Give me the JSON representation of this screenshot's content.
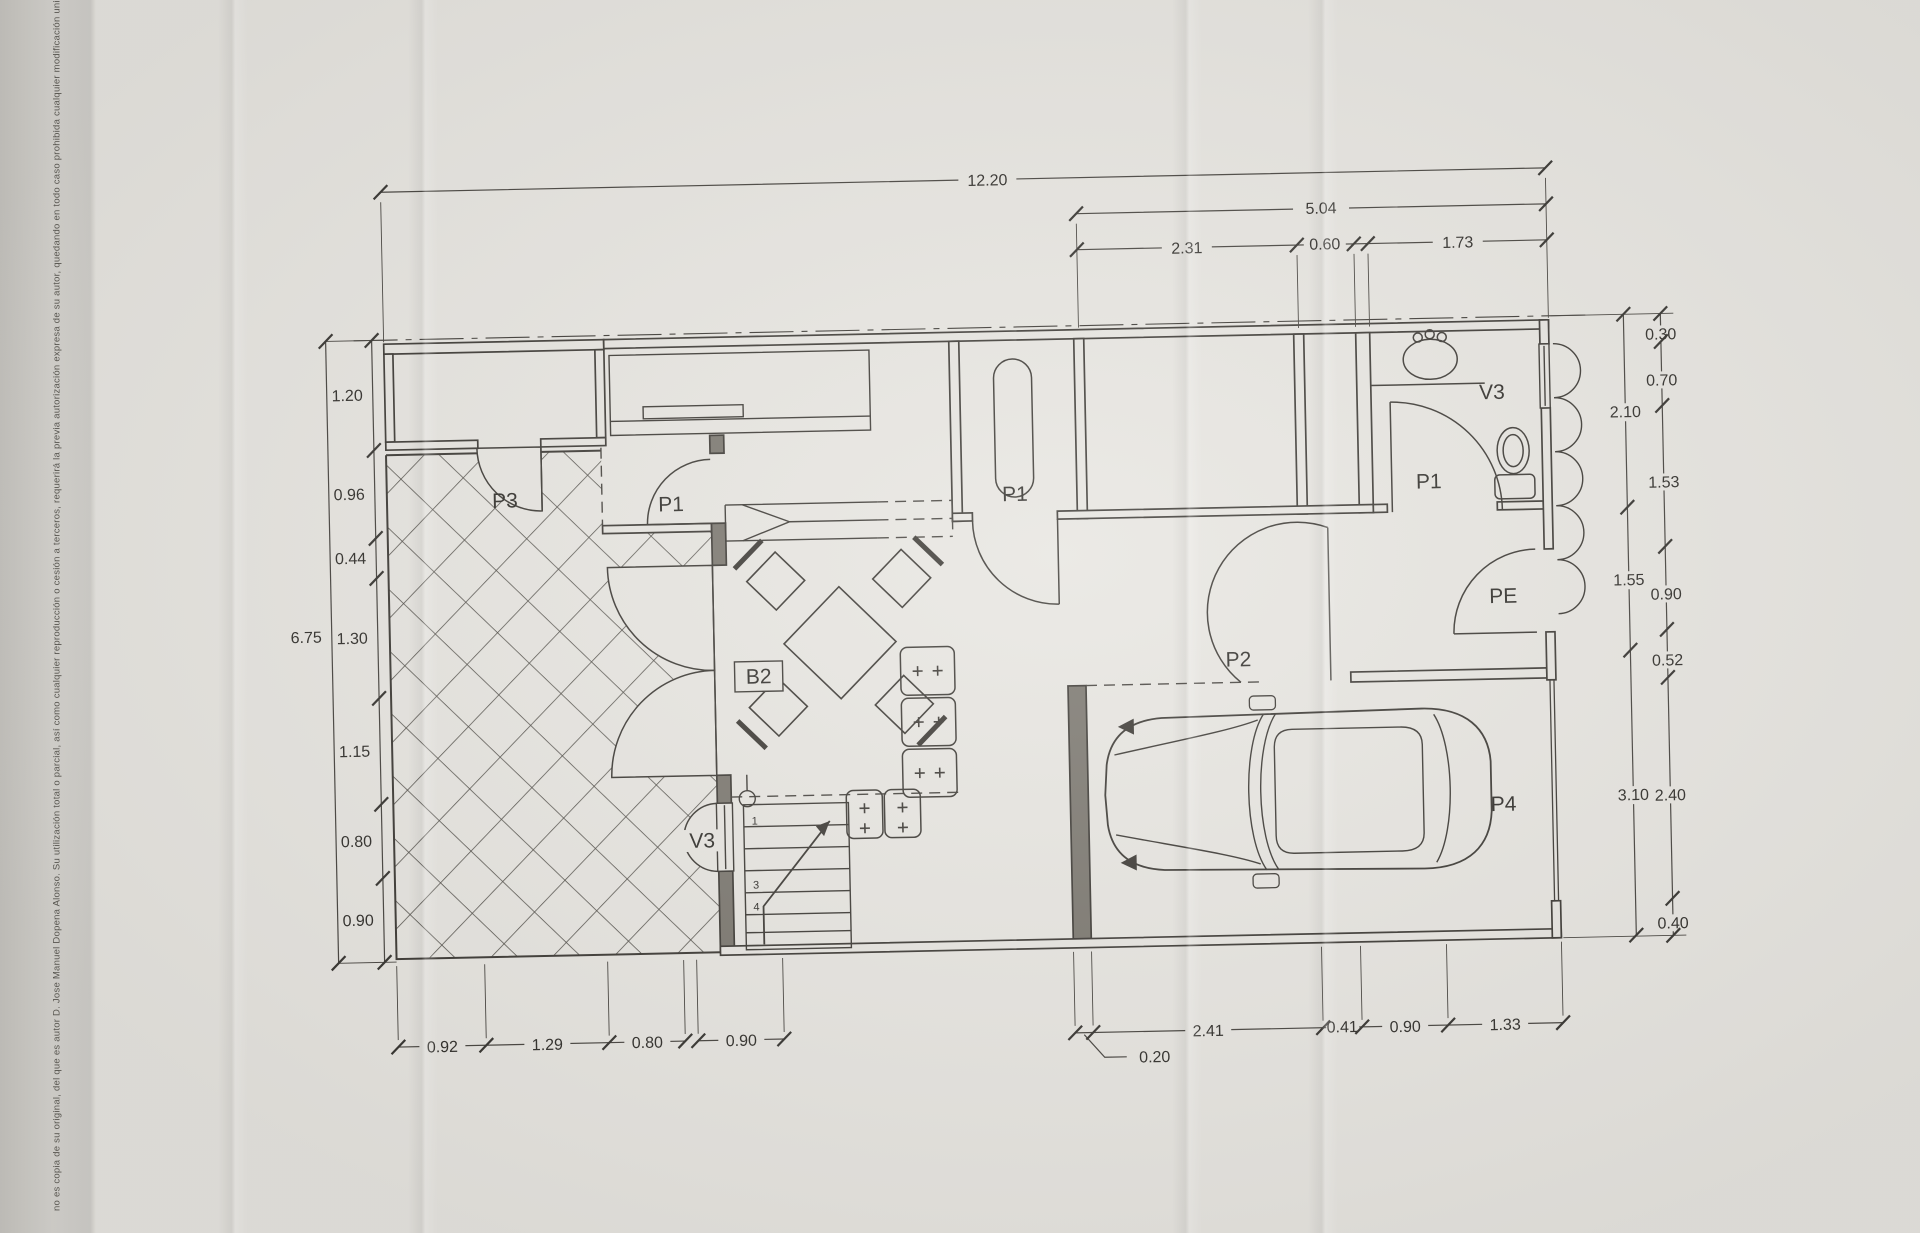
{
  "copyright": "no es copia de su original, del que es autor D. Jose Manuel Dopena Alonso. Su utilización total o parcial, así como cualquier reproducción o cesión a terceros, requerirá la previa autorización expresa de su autor, quedando en todo caso prohibida cualquier modificación unilateral del mismo.",
  "dims": {
    "top_total": "12.20",
    "right_zone_total": "5.04",
    "rz_a": "2.31",
    "rz_b": "0.60",
    "rz_c": "1.73",
    "left_total": "6.75",
    "l1": "1.20",
    "l2": "0.96",
    "l3": "0.44",
    "l4": "1.30",
    "l5": "1.15",
    "l6": "0.80",
    "l7": "0.90",
    "ri1": "2.10",
    "ri2": "1.55",
    "ri3": "3.10",
    "ro1": "0.30",
    "ro2": "0.70",
    "ro3": "1.53",
    "ro4": "0.90",
    "ro5": "0.52",
    "ro6": "2.40",
    "ro7": "0.40",
    "b1": "0.92",
    "b2": "1.29",
    "b3": "0.80",
    "b4": "0.90",
    "g0": "0.20",
    "g1": "2.41",
    "g2": "0.41",
    "g3": "0.90",
    "g4": "1.33"
  },
  "rooms": {
    "p3": "P3",
    "p1_vestibule": "P1",
    "b2": "B2",
    "v3_stairs": "V3",
    "p1_room": "P1",
    "p2": "P2",
    "p1_bath": "P1",
    "v3_bath": "V3",
    "pe": "PE",
    "p4": "P4"
  },
  "stairs": {
    "n1": "1",
    "n2": "3",
    "n3": "4"
  }
}
